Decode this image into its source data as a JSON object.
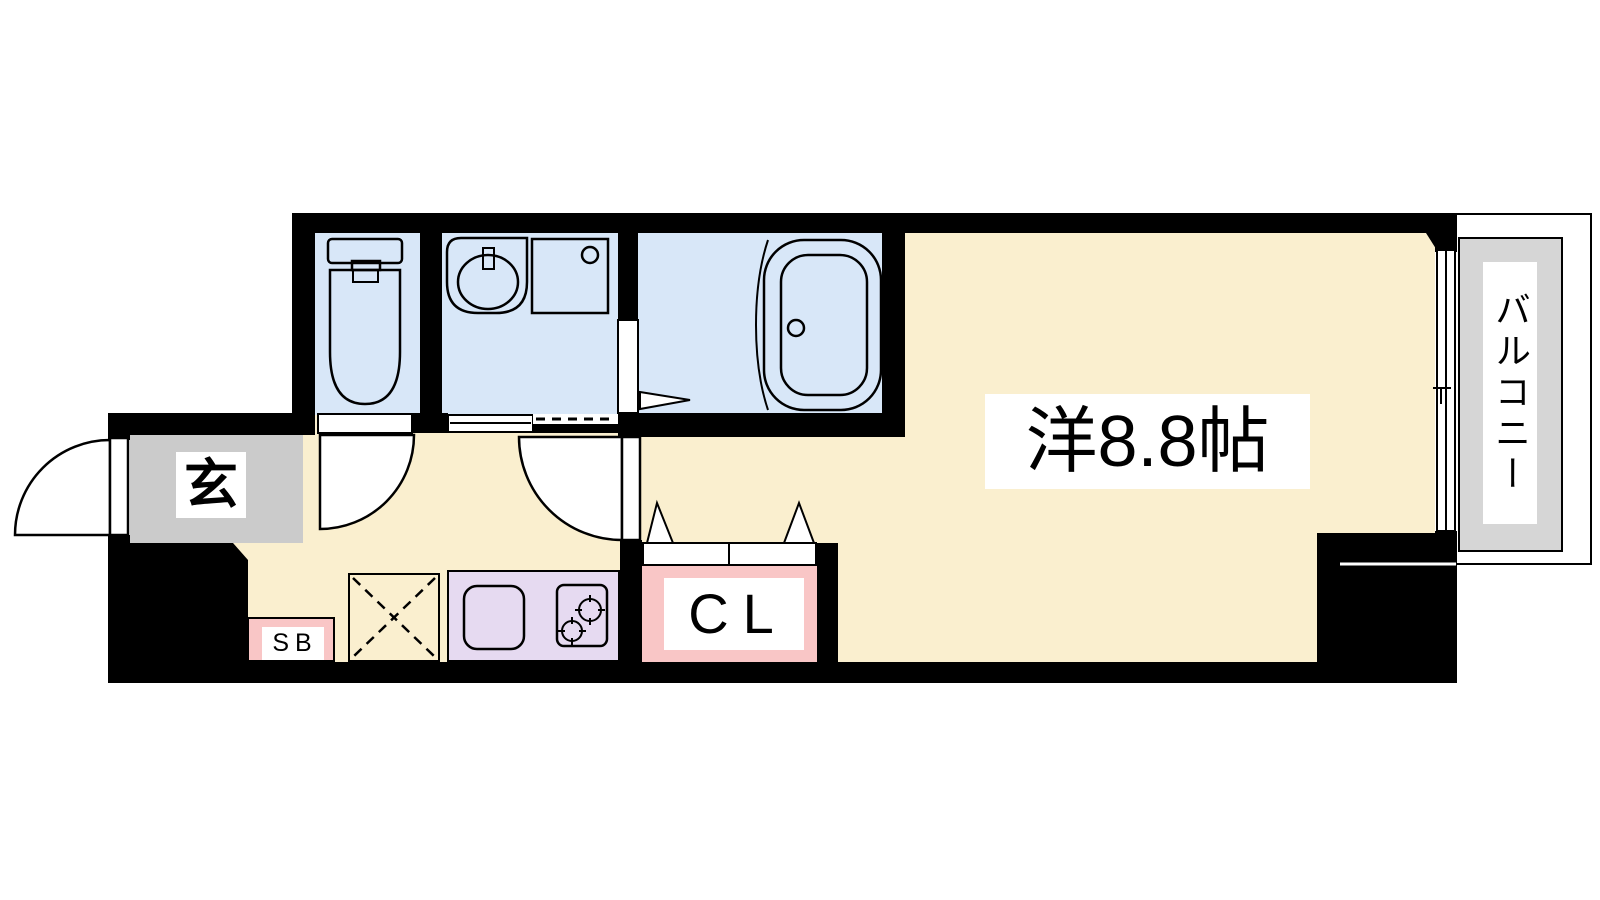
{
  "floorplan": {
    "rooms": {
      "main_room": {
        "label": "洋8.8帖"
      },
      "balcony": {
        "label": "バルコニー"
      },
      "entrance": {
        "label": "玄"
      },
      "closet": {
        "label": "CL"
      },
      "shoe_box": {
        "label": "SB"
      }
    },
    "fixtures": [
      "toilet-icon",
      "washbasin-icon",
      "washing-machine-pan-icon",
      "bathtub-icon",
      "kitchen-sink-icon",
      "stove-icon",
      "refrigerator-space-icon",
      "sliding-window-icon",
      "door-swing-icon",
      "sliding-door-icon",
      "double-door-triangles-icon"
    ],
    "colors": {
      "background": "#FFFFFF",
      "wall-black": "#000000",
      "floor-cream": "#FAEFCF",
      "wet-area-blue": "#D8E7F8",
      "kitchen-purple": "#E6DAF1",
      "storage-pink": "#F9C6C6",
      "entrance-gray": "#CBCBCB",
      "balcony-gray": "#D6D6D6"
    }
  }
}
